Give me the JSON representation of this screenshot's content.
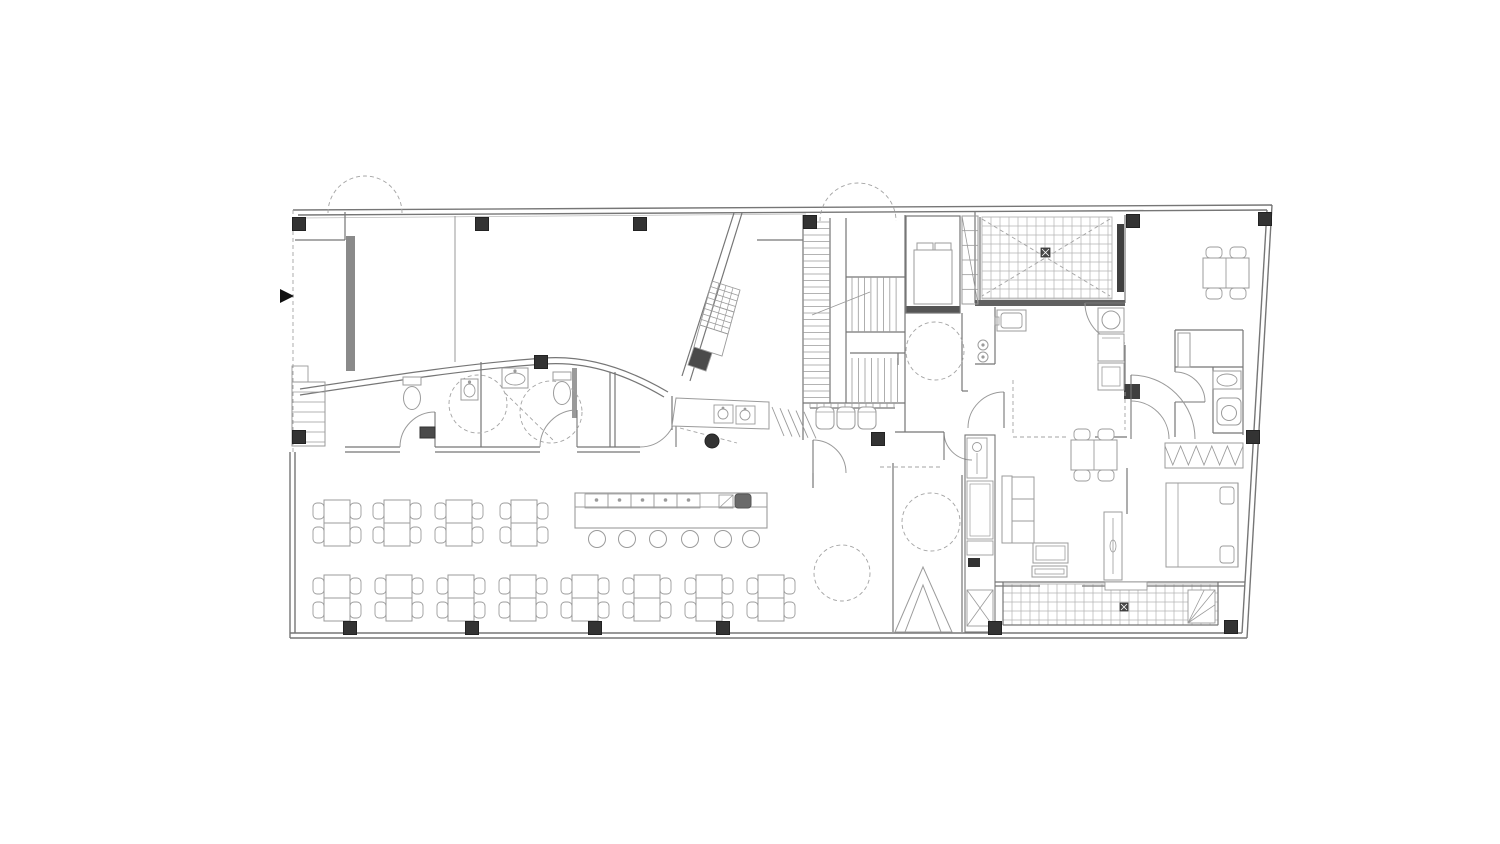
{
  "canvas": {
    "w": 1500,
    "h": 844,
    "bg": "#ffffff"
  },
  "palette": {
    "wall": "#767676",
    "wall_light": "#9a9a9a",
    "furniture": "#9b9b9b",
    "grid": "#b4b4b4",
    "dash": "#a3a3a3",
    "column": "#333333",
    "dark": "#4a4a4a",
    "arrow": "#111111"
  },
  "plan": {
    "outer_walls": [
      [
        293,
        210,
        1272,
        205
      ],
      [
        298,
        215,
        1267,
        210
      ],
      [
        1272,
        205,
        1247,
        638
      ],
      [
        1267,
        210,
        1242,
        633
      ],
      [
        1247,
        638,
        290,
        638
      ],
      [
        1242,
        633,
        290,
        633
      ],
      [
        290,
        638,
        290,
        452
      ],
      [
        295,
        633,
        295,
        452
      ]
    ],
    "walls": [
      [
        345,
        212,
        345,
        240
      ],
      [
        295,
        240,
        345,
        240
      ],
      [
        345,
        447,
        400,
        447
      ],
      [
        345,
        452,
        400,
        452
      ],
      [
        435,
        447,
        540,
        447
      ],
      [
        435,
        452,
        540,
        452
      ],
      [
        577,
        447,
        640,
        447
      ],
      [
        577,
        452,
        640,
        452
      ],
      [
        481,
        362,
        481,
        447
      ],
      [
        610,
        372,
        610,
        447
      ],
      [
        615,
        372,
        615,
        447
      ],
      [
        672,
        396,
        672,
        430
      ],
      [
        803,
        215,
        803,
        440
      ],
      [
        813,
        473,
        813,
        488
      ],
      [
        830,
        218,
        830,
        403
      ],
      [
        846,
        218,
        846,
        403
      ],
      [
        846,
        277,
        905,
        277
      ],
      [
        846,
        332,
        905,
        332
      ],
      [
        850,
        353,
        905,
        353
      ],
      [
        898,
        353,
        898,
        365
      ],
      [
        803,
        403,
        905,
        403
      ],
      [
        810,
        408,
        895,
        408
      ],
      [
        905,
        215,
        905,
        432
      ],
      [
        895,
        432,
        944,
        432
      ],
      [
        893,
        463,
        893,
        632
      ],
      [
        962,
        313,
        962,
        391
      ],
      [
        962,
        475,
        962,
        632
      ],
      [
        962,
        391,
        968,
        391
      ],
      [
        975,
        212,
        975,
        303
      ],
      [
        980,
        217,
        980,
        303
      ],
      [
        995,
        307,
        995,
        364
      ],
      [
        975,
        364,
        995,
        364
      ],
      [
        1125,
        215,
        1125,
        303
      ],
      [
        1125,
        345,
        1125,
        392
      ],
      [
        1175,
        330,
        1243,
        330
      ],
      [
        1175,
        330,
        1175,
        372
      ],
      [
        1175,
        402,
        1175,
        437
      ],
      [
        1175,
        367,
        1243,
        367
      ],
      [
        1213,
        367,
        1213,
        433
      ],
      [
        1243,
        330,
        1243,
        435
      ],
      [
        1213,
        433,
        1243,
        433
      ],
      [
        1095,
        437,
        1127,
        437
      ],
      [
        1127,
        468,
        1127,
        514
      ],
      [
        995,
        582,
        1245,
        582
      ],
      [
        995,
        586,
        1040,
        586
      ],
      [
        1082,
        586,
        1245,
        586
      ],
      [
        1003,
        582,
        1003,
        625
      ],
      [
        1218,
        582,
        1218,
        625
      ],
      [
        1003,
        625,
        1218,
        625
      ],
      [
        757,
        240,
        803,
        240
      ]
    ],
    "thin_walls": [
      [
        455,
        216,
        455,
        362
      ]
    ],
    "sills": [
      [
        300,
        218,
        806,
        214
      ]
    ],
    "curves": [
      "M300,389 C380,377 470,363 545,358 C592,355 634,372 668,392",
      "M300,395 C380,383 470,369 545,364 C592,361 632,378 664,397"
    ],
    "diagonals": [
      [
        734,
        213,
        682,
        376
      ],
      [
        742,
        213,
        690,
        381
      ]
    ],
    "gray_bars": [
      [
        346,
        236,
        9,
        135,
        "#8a8a8a"
      ],
      [
        572,
        368,
        5,
        50,
        "#9a9a9a"
      ],
      [
        975,
        300,
        150,
        6,
        "#606060"
      ],
      [
        1117,
        224,
        7,
        68,
        "#3f3f3f"
      ],
      [
        906,
        306,
        54,
        7,
        "#555555"
      ],
      [
        1124,
        384,
        16,
        15,
        "#3f3f3f"
      ],
      [
        968,
        558,
        12,
        9,
        "#333333"
      ]
    ],
    "columns": [
      [
        299,
        224
      ],
      [
        482,
        224
      ],
      [
        640,
        224
      ],
      [
        810,
        222
      ],
      [
        1133,
        221
      ],
      [
        1265,
        219
      ],
      [
        541,
        362
      ],
      [
        878,
        439
      ],
      [
        299,
        437
      ],
      [
        350,
        628
      ],
      [
        472,
        628
      ],
      [
        595,
        628
      ],
      [
        723,
        628
      ],
      [
        995,
        628
      ],
      [
        1231,
        627
      ],
      [
        1253,
        437
      ]
    ],
    "dot_columns": [
      [
        712,
        441,
        7
      ]
    ],
    "doors": [
      {
        "d": "M400,447 A35,35 0 0 1 435,412",
        "leaf": [
          435,
          412,
          435,
          447
        ]
      },
      {
        "d": "M540,447 A37,37 0 0 1 577,410",
        "leaf": [
          577,
          410,
          577,
          447
        ]
      },
      {
        "d": "M640,447 A36,36 0 0 0 676,411",
        "leaf": [
          676,
          411,
          676,
          447
        ]
      },
      {
        "d": "M813,440 A33,33 0 0 1 846,473",
        "leaf": [
          813,
          440,
          813,
          473
        ]
      },
      {
        "d": "M1085,303 A40,40 0 0 0 1125,343",
        "leaf": [
          1085,
          303,
          1125,
          303
        ]
      },
      {
        "d": "M1175,372 A30,30 0 0 1 1205,402",
        "leaf": [
          1205,
          402,
          1175,
          402
        ]
      },
      {
        "d": "M1131,375 A64,64 0 0 1 1195,439",
        "leaf": [
          1131,
          375,
          1131,
          439
        ]
      },
      {
        "d": "M1169,439 A38,38 0 0 0 1131,401",
        "leaf": null
      },
      {
        "d": "M968,428 A36,36 0 0 1 1004,392",
        "leaf": [
          1004,
          392,
          1004,
          428
        ]
      },
      {
        "d": "M944,432 A28,28 0 0 0 972,460",
        "leaf": [
          944,
          432,
          944,
          460
        ]
      }
    ],
    "dashed_arcs": [
      "M328,213 A37,37 0 0 1 402,213",
      "M820,221 A38,38 0 0 1 896,221"
    ],
    "dashed_circles": [
      [
        478,
        404,
        29
      ],
      [
        551,
        412,
        31
      ],
      [
        935,
        351,
        29
      ],
      [
        931,
        522,
        29
      ],
      [
        842,
        573,
        28
      ]
    ],
    "dashed_lines": [
      [
        293,
        210,
        293,
        452
      ],
      [
        505,
        393,
        553,
        440
      ],
      [
        680,
        428,
        737,
        443
      ],
      [
        982,
        219,
        1110,
        296
      ],
      [
        1110,
        219,
        982,
        296
      ],
      [
        1013,
        437,
        1068,
        437
      ],
      [
        1013,
        380,
        1013,
        435
      ],
      [
        1125,
        392,
        1125,
        430
      ],
      [
        880,
        467,
        940,
        467
      ]
    ],
    "grids": [
      {
        "x": 982,
        "y": 217,
        "w": 130,
        "h": 82,
        "cell": 9
      },
      {
        "x": 1003,
        "y": 584,
        "w": 215,
        "h": 41,
        "cell": 9
      }
    ],
    "stairs": {
      "flightA": {
        "x0": 803,
        "x1": 830,
        "y0": 222,
        "y1": 400,
        "step": 6.5
      },
      "flightB": {
        "y0": 277,
        "y1": 332,
        "x0": 852,
        "x1": 902,
        "step": 6.3
      },
      "flightC": {
        "y0": 358,
        "y1": 402,
        "x0": 852,
        "x1": 898,
        "step": 6.5
      },
      "ticks": {
        "x0": 810,
        "x1": 895,
        "y0": 403,
        "y1": 408,
        "step": 7
      },
      "arrow": [
        812,
        315,
        870,
        292
      ]
    },
    "elevator": {
      "shaft": [
        906,
        216,
        54,
        97
      ],
      "cab": [
        914,
        250,
        38,
        54
      ],
      "rollers": [
        [
          917,
          243,
          16,
          7
        ],
        [
          935,
          243,
          16,
          7
        ]
      ]
    },
    "duct": {
      "x": 962,
      "y": 216,
      "w": 16,
      "h": 88,
      "lines": 5
    },
    "dumb_cells": [
      {
        "pts": [
          [
            712,
            281
          ],
          [
            740,
            290
          ],
          [
            734,
            312
          ],
          [
            706,
            303
          ]
        ],
        "hatch": true,
        "fill": "none"
      },
      {
        "pts": [
          [
            706,
            303
          ],
          [
            734,
            312
          ],
          [
            728,
            334
          ],
          [
            700,
            325
          ]
        ],
        "hatch": true,
        "fill": "none"
      },
      {
        "pts": [
          [
            700,
            325
          ],
          [
            728,
            334
          ],
          [
            722,
            356
          ],
          [
            694,
            347
          ]
        ],
        "hatch": false,
        "fill": "none"
      },
      {
        "pts": [
          [
            694,
            347
          ],
          [
            712,
            353
          ],
          [
            706,
            371
          ],
          [
            688,
            365
          ]
        ],
        "hatch": false,
        "fill": "#4a4a4a"
      }
    ],
    "tables": {
      "v_positions": [
        [
          337,
          523
        ],
        [
          397,
          523
        ],
        [
          459,
          523
        ],
        [
          524,
          523
        ],
        [
          337,
          598
        ],
        [
          399,
          598
        ],
        [
          461,
          598
        ],
        [
          523,
          598
        ],
        [
          585,
          598
        ],
        [
          647,
          598
        ],
        [
          709,
          598
        ],
        [
          771,
          598
        ]
      ],
      "h_positions": [
        [
          1094,
          455
        ],
        [
          1226,
          273
        ]
      ]
    },
    "stools": {
      "r": 8.5,
      "cy": 539,
      "cx": [
        597,
        627,
        658,
        690,
        723,
        751
      ]
    },
    "bar": {
      "x": 575,
      "y": 493,
      "w": 192,
      "h": 35,
      "band_y": 507,
      "cells": {
        "x0": 585,
        "n": 5,
        "w": 23,
        "h": 14
      },
      "sq": [
        719,
        495,
        14,
        13
      ],
      "register": [
        735,
        494,
        16,
        14
      ]
    },
    "entry_triangles": [
      [
        [
          895,
          632
        ],
        [
          923,
          567
        ],
        [
          952,
          632
        ]
      ],
      [
        [
          905,
          632
        ],
        [
          923,
          585
        ],
        [
          941,
          632
        ]
      ]
    ],
    "steps_pass": {
      "x0": 772,
      "y0": 407,
      "n": 5,
      "dx": 8
    },
    "fixtures": [
      {
        "t": "toilet",
        "x": 403,
        "y": 377
      },
      {
        "t": "toilet",
        "x": 553,
        "y": 372
      },
      {
        "t": "sink",
        "x": 461,
        "y": 379,
        "w": 17,
        "h": 21
      },
      {
        "t": "sink",
        "x": 502,
        "y": 368,
        "w": 26,
        "h": 20
      },
      {
        "t": "darkbox",
        "x": 420,
        "y": 427,
        "w": 15,
        "h": 11
      },
      {
        "t": "csinks",
        "x": 672,
        "y": 396
      },
      {
        "t": "seats3",
        "x": 816,
        "y": 407
      },
      {
        "t": "ksink",
        "x": 997,
        "y": 310
      },
      {
        "t": "burners",
        "x": 983,
        "y": 345
      },
      {
        "t": "fridge",
        "x": 1098,
        "y": 308
      },
      {
        "t": "pantry",
        "x": 1098,
        "y": 334
      },
      {
        "t": "sinkoval",
        "x": 1213,
        "y": 371,
        "w": 28,
        "h": 18
      },
      {
        "t": "toilet2",
        "x": 1217,
        "y": 398
      },
      {
        "t": "shower",
        "x": 1178,
        "y": 333,
        "w": 12,
        "h": 34
      },
      {
        "t": "wardrobe",
        "x": 1165,
        "y": 443,
        "w": 78,
        "h": 25
      },
      {
        "t": "bed",
        "x": 1166,
        "y": 483,
        "w": 72,
        "h": 84
      },
      {
        "t": "sliding",
        "x": 1104,
        "y": 512,
        "w": 18,
        "h": 68
      },
      {
        "t": "bump",
        "x": 1105,
        "y": 582,
        "w": 42,
        "h": 8
      },
      {
        "t": "sofa",
        "x": 1002,
        "y": 476
      },
      {
        "t": "ctable",
        "x": 1033,
        "y": 543,
        "w": 35,
        "h": 20
      },
      {
        "t": "ctable",
        "x": 1032,
        "y": 566,
        "w": 35,
        "h": 11
      },
      {
        "t": "hallcolumn",
        "x": 965,
        "y": 435
      },
      {
        "t": "stepsblock",
        "x": 292,
        "y": 382
      },
      {
        "t": "ramptri",
        "x": 1188,
        "y": 590,
        "w": 27,
        "h": 33
      },
      {
        "t": "drain",
        "x": 1041,
        "y": 248,
        "s": 9
      },
      {
        "t": "drain",
        "x": 1120,
        "y": 603,
        "s": 8
      }
    ],
    "arrow_marker": [
      [
        280,
        289
      ],
      [
        280,
        303
      ],
      [
        294,
        296
      ]
    ]
  }
}
